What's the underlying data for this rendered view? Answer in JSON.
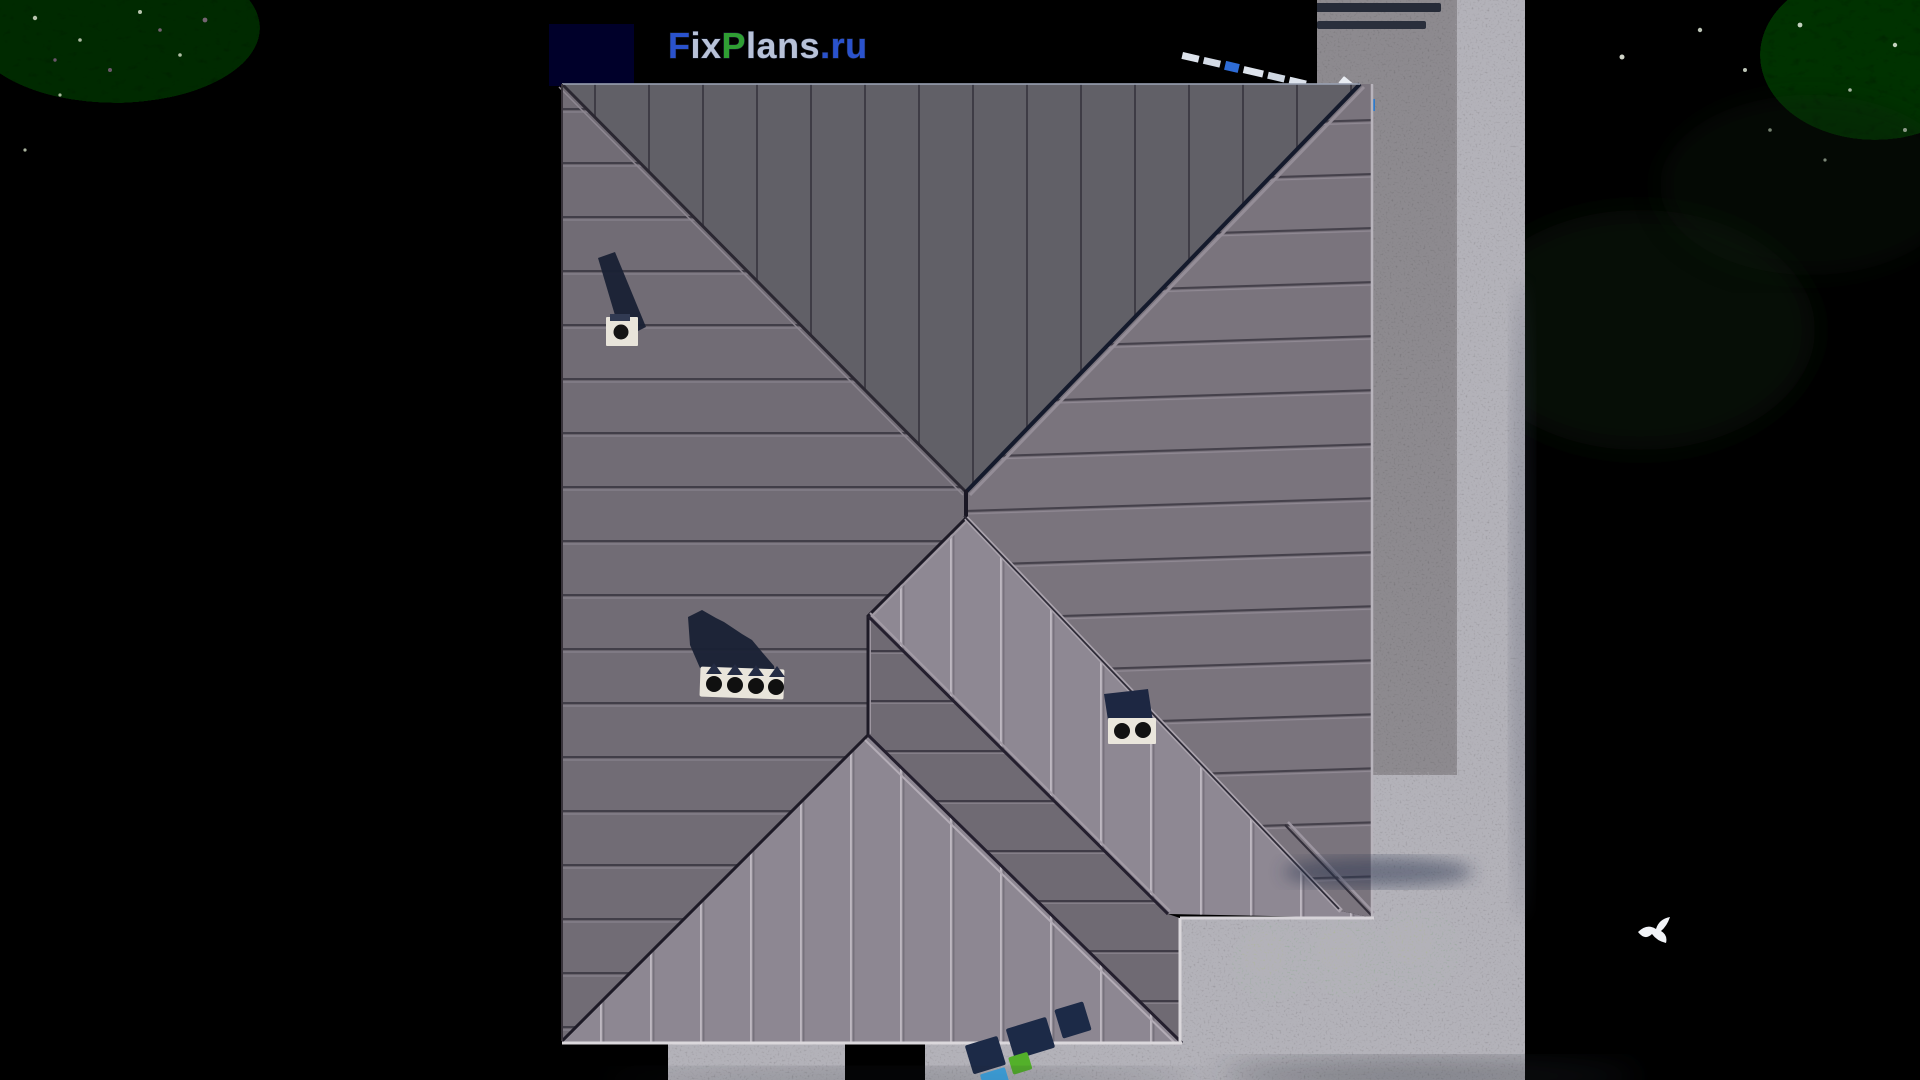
{
  "watermark": {
    "segments": [
      {
        "text": "F",
        "color": "#2a52cc"
      },
      {
        "text": "ix",
        "color": "#b8c2d8"
      },
      {
        "text": "P",
        "color": "#2f9e33"
      },
      {
        "text": "lans",
        "color": "#b8c2d8"
      },
      {
        "text": ".ru",
        "color": "#2a52cc"
      }
    ]
  },
  "palette": {
    "grass_base": "#2a411c",
    "grass_light": "#36511f",
    "foliage": "#4a6a2e",
    "roof_north": "#616067",
    "roof_west": "#716c75",
    "roof_east": "#7a747d",
    "roof_sunlit": "#8e8893",
    "roof_triangle": "#8d8792",
    "roof_wing": "#6f6a73",
    "terrace": "#333b52",
    "terrace_light": "#5c6582",
    "gravel": "#c7c4c8",
    "path": "#e9e8ee",
    "garden_bed": "#2c451c",
    "bush": "#83a851",
    "logo_navy": "#1c2a47",
    "logo_green": "#53b02a",
    "logo_blue": "#3fa9e8",
    "shadow_navy": "#1a2134"
  },
  "roof": {
    "chimneys": [
      {
        "id": "chimney-a",
        "vents": 1
      },
      {
        "id": "chimney-b",
        "vents": 4
      },
      {
        "id": "chimney-c",
        "vents": 2
      }
    ]
  }
}
